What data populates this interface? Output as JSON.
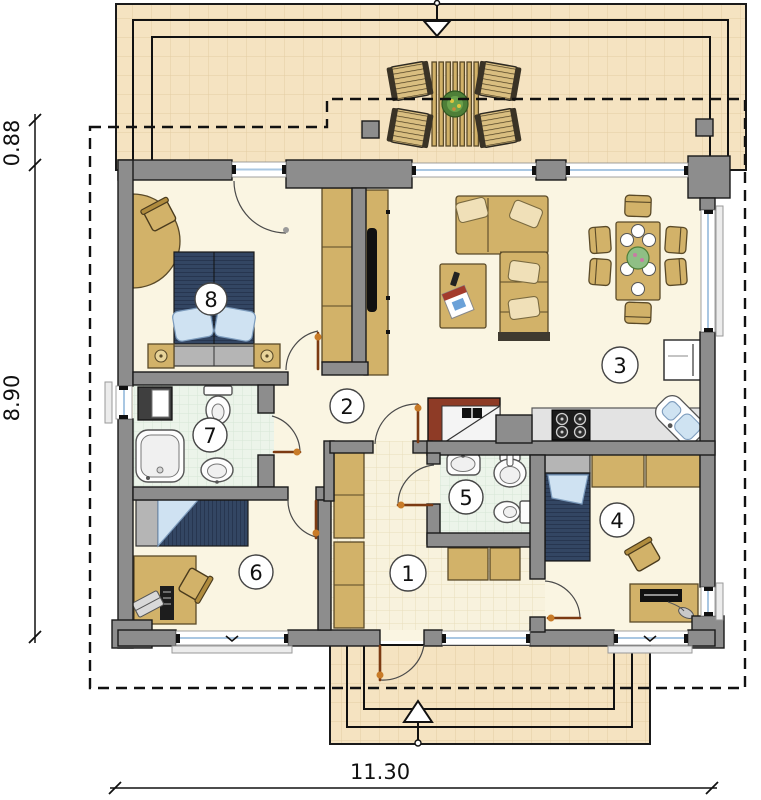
{
  "title": "single-storey house floor plan",
  "dimensions": {
    "left_top": "0.88",
    "left_side": "8.90",
    "bottom_width": "11.30"
  },
  "rooms": [
    {
      "number": "1"
    },
    {
      "number": "2"
    },
    {
      "number": "3"
    },
    {
      "number": "4"
    },
    {
      "number": "5"
    },
    {
      "number": "6"
    },
    {
      "number": "7"
    },
    {
      "number": "8"
    }
  ],
  "colors": {
    "wall": "#8d8d8d",
    "terrace_tile": "#f5e3c1",
    "interior_floor": "#faf5e2",
    "bath_tile": "#ecf4ea",
    "hall_tile": "#f8f2dd",
    "furniture": "#d2b269",
    "bed_cover": "#334663",
    "pillow": "#cfe2f2",
    "fireplace": "#8e3b26",
    "door_leaf": "#7c3a12",
    "hinge_dot": "#c87b28",
    "window_glass": "#a9c7e2"
  }
}
